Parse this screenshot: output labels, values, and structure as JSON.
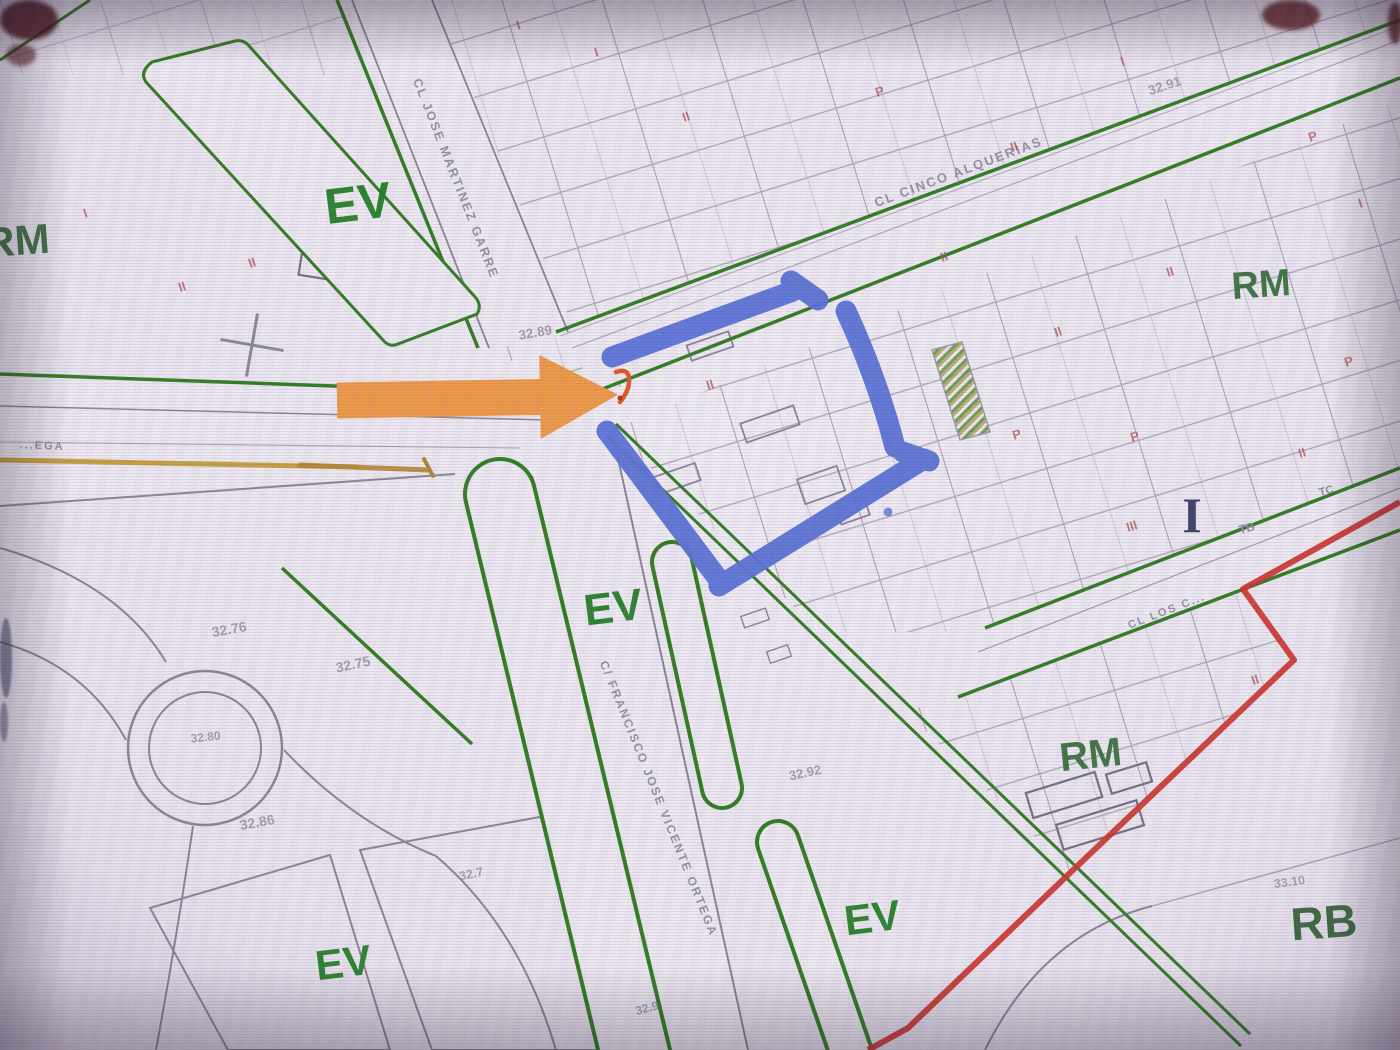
{
  "scene": {
    "description": "Photo of a monitor showing a Spanish cadastral zoning map with a blue hand-drawn square and an orange arrow annotation"
  },
  "map": {
    "zone_labels": [
      {
        "code": "EV"
      },
      {
        "code": "EV"
      },
      {
        "code": "EV"
      },
      {
        "code": "EV"
      },
      {
        "code": "RM"
      },
      {
        "code": "RM"
      },
      {
        "code": "RM"
      },
      {
        "code": "RB"
      }
    ],
    "street_labels": [
      {
        "name": "CL JOSE MARTINEZ GARRE"
      },
      {
        "name": "CL CINCO ALQUERIAS"
      },
      {
        "name": "C/ FRANCISCO JOSE VICENTE ORTEGA"
      },
      {
        "name": "...EGA"
      },
      {
        "name": "CL LOS C..."
      }
    ],
    "elevation_labels": [
      {
        "value": "32.89"
      },
      {
        "value": "32.91"
      },
      {
        "value": "32.76"
      },
      {
        "value": "32.75"
      },
      {
        "value": "32.80"
      },
      {
        "value": "32.86"
      },
      {
        "value": "32.7"
      },
      {
        "value": "32.92"
      },
      {
        "value": "33.10"
      },
      {
        "value": "32.9"
      }
    ],
    "parcel_marks": [
      {
        "text": "II"
      },
      {
        "text": "I"
      },
      {
        "text": "II"
      },
      {
        "text": "I"
      },
      {
        "text": "P"
      },
      {
        "text": "II"
      },
      {
        "text": "I"
      },
      {
        "text": "P"
      },
      {
        "text": "II"
      },
      {
        "text": "II"
      },
      {
        "text": "II"
      },
      {
        "text": "P"
      },
      {
        "text": "P"
      },
      {
        "text": "P"
      },
      {
        "text": "II"
      },
      {
        "text": "III"
      },
      {
        "text": "II"
      },
      {
        "text": "II"
      },
      {
        "text": "I"
      },
      {
        "text": "II"
      },
      {
        "text": "I"
      }
    ],
    "special_marks": [
      {
        "text": "I"
      },
      {
        "text": "TB"
      },
      {
        "text": "TC"
      }
    ],
    "colors": {
      "zone_boundary_green": "#2e7d1b",
      "zone_label_green": "#1d7f1d",
      "parcel_line": "#a39aab",
      "road_edge": "#8b8694",
      "boundary_red": "#cf3126",
      "utility_yellow": "#c9a23a",
      "annotation_blue": "#5a73d8",
      "annotation_orange": "#f49b42",
      "tip_mark_orange": "#e05a1e"
    }
  }
}
